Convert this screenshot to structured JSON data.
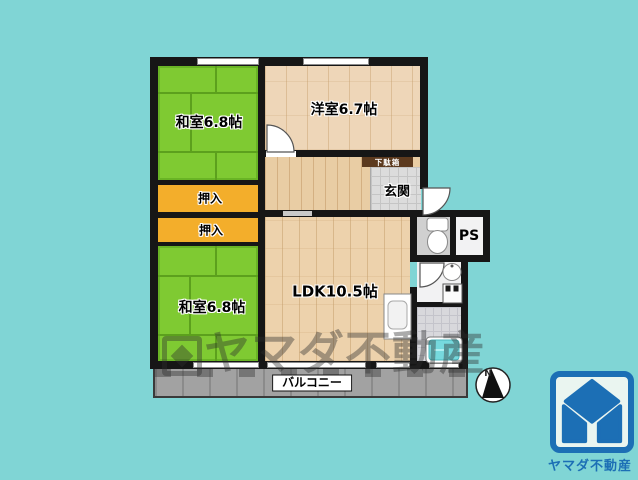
{
  "plan": {
    "rooms": {
      "washitsu_top": "和室6.8帖",
      "western_room": "洋室6.7帖",
      "closet_top": "押入",
      "closet_bottom": "押入",
      "washitsu_bottom": "和室6.8帖",
      "ldk": "LDK10.5帖",
      "entrance": "玄関",
      "shoe_cabinet": "下駄箱",
      "pipe_space": "PS",
      "balcony": "バルコニー"
    },
    "compass_label": "N"
  },
  "watermark": {
    "text": "ヤマダ不動産"
  },
  "branding": {
    "company": "ヤマダ不動産"
  },
  "colors": {
    "background": "#80D5D5",
    "tatami_green": "#7FCA32",
    "closet_orange": "#F3AE2B",
    "wood_beige": "#EED6B8",
    "wall_black": "#161616",
    "bathtub_cyan": "#76D9DE",
    "balcony_gray": "#A2A2A2",
    "logo_blue": "#1C6FB5",
    "logo_background": "#EAF5F0"
  }
}
